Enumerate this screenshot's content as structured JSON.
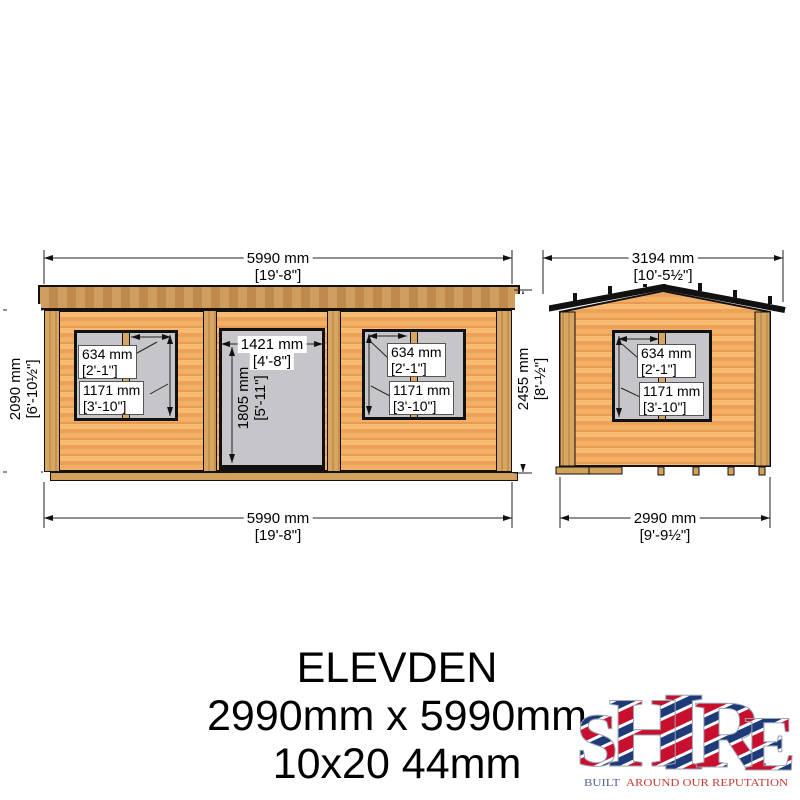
{
  "drawing": {
    "front_elevation": {
      "top_width": {
        "mm": "5990 mm",
        "ftin": "[19'-8\"]"
      },
      "bottom_width": {
        "mm": "5990 mm",
        "ftin": "[19'-8\"]"
      },
      "wall_height": {
        "mm": "2090 mm",
        "ftin": "[6'-10½\"]"
      },
      "door": {
        "width": {
          "mm": "1421 mm",
          "ftin": "[4'-8\"]"
        },
        "height": {
          "mm": "1805 mm",
          "ftin": "[5'-11\"]"
        }
      },
      "left_window": {
        "pane_width": {
          "mm": "634 mm",
          "ftin": "[2'-1\"]"
        },
        "height": {
          "mm": "1171 mm",
          "ftin": "[3'-10\"]"
        }
      },
      "right_window": {
        "pane_width": {
          "mm": "634 mm",
          "ftin": "[2'-1\"]"
        },
        "height": {
          "mm": "1171 mm",
          "ftin": "[3'-10\"]"
        }
      }
    },
    "side_elevation": {
      "roof_width": {
        "mm": "3194 mm",
        "ftin": "[10'-5½\"]"
      },
      "ridge_height": {
        "mm": "2455 mm",
        "ftin": "[8'-½\"]"
      },
      "wall_width": {
        "mm": "2990 mm",
        "ftin": "[9'-9½\"]"
      },
      "window": {
        "pane_width": {
          "mm": "634 mm",
          "ftin": "[2'-1\"]"
        },
        "height": {
          "mm": "1171 mm",
          "ftin": "[3'-10\"]"
        }
      }
    }
  },
  "title_block": {
    "model": "ELEVDEN",
    "dimensions": "2990mm x 5990mm",
    "size_code": "10x20 44mm"
  },
  "logo": {
    "letters": [
      "S",
      "H",
      "I",
      "R",
      "E"
    ],
    "tagline_left": "BUILT",
    "tagline_right": "AROUND OUR REPUTATION"
  },
  "colors": {
    "wall_light": "#f7bb72",
    "wall_dark": "#eda25a",
    "fascia": "#cf9d60",
    "trim": "#d7a662",
    "glass": "#c6c6ca",
    "line": "#111111",
    "logo_red": "#c8102e",
    "logo_blue": "#1e3a78"
  }
}
